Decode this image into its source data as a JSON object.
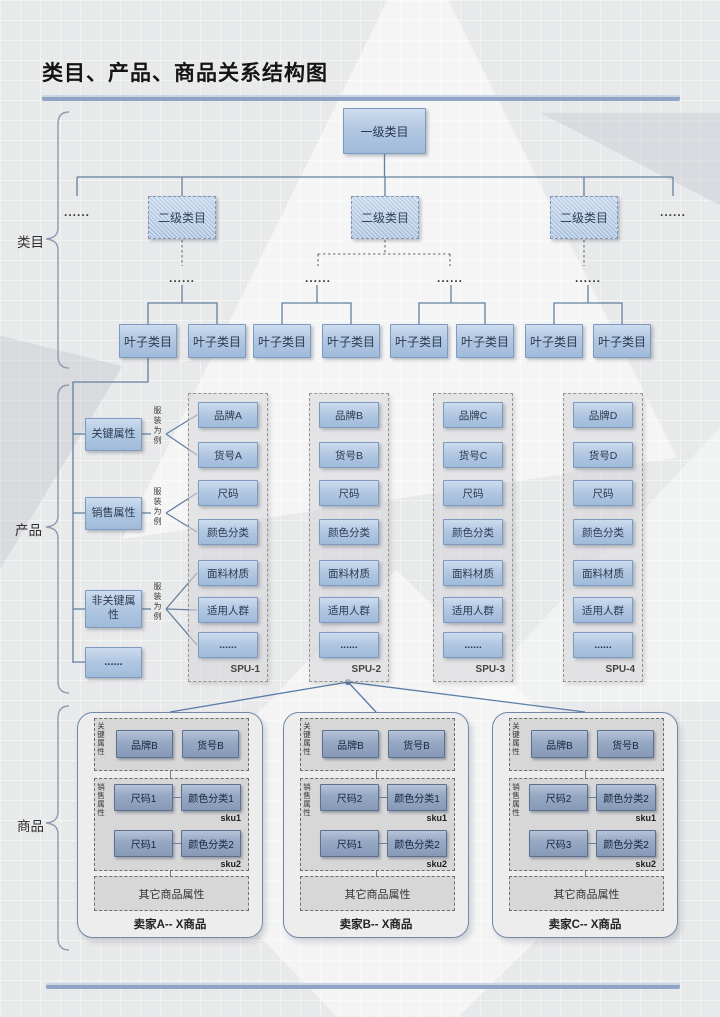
{
  "title": "类目、产品、商品关系结构图",
  "category": {
    "label": "类目",
    "root": "一级类目",
    "level2": [
      "二级类目",
      "二级类目",
      "二级类目"
    ],
    "ellipsis": "......",
    "leaves": [
      "叶子类目",
      "叶子类目",
      "叶子类目",
      "叶子类目",
      "叶子类目",
      "叶子类目",
      "叶子类目",
      "叶子类目"
    ]
  },
  "product": {
    "label": "产品",
    "groups": [
      {
        "name": "关键属性",
        "note": "服装为例"
      },
      {
        "name": "销售属性",
        "note": "服装为例"
      },
      {
        "name": "非关键属性",
        "note": "服装为例"
      }
    ],
    "more": "......",
    "spus": [
      {
        "name": "SPU-1",
        "attrs": [
          "品牌A",
          "货号A",
          "尺码",
          "颜色分类",
          "面料材质",
          "适用人群",
          "......"
        ]
      },
      {
        "name": "SPU-2",
        "attrs": [
          "品牌B",
          "货号B",
          "尺码",
          "颜色分类",
          "面料材质",
          "适用人群",
          "......"
        ]
      },
      {
        "name": "SPU-3",
        "attrs": [
          "品牌C",
          "货号C",
          "尺码",
          "颜色分类",
          "面料材质",
          "适用人群",
          "......"
        ]
      },
      {
        "name": "SPU-4",
        "attrs": [
          "品牌D",
          "货号D",
          "尺码",
          "颜色分类",
          "面料材质",
          "适用人群",
          "......"
        ]
      }
    ]
  },
  "commodity": {
    "label": "商品",
    "key_attr_label": "关键属性",
    "sales_attr_label": "销售属性",
    "cards": [
      {
        "title": "卖家A-- X商品",
        "brand": "品牌B",
        "item_no": "货号B",
        "other": "其它商品属性",
        "skus": [
          {
            "size": "尺码1",
            "color": "颜色分类1",
            "tag": "sku1"
          },
          {
            "size": "尺码1",
            "color": "颜色分类2",
            "tag": "sku2"
          }
        ]
      },
      {
        "title": "卖家B-- X商品",
        "brand": "品牌B",
        "item_no": "货号B",
        "other": "其它商品属性",
        "skus": [
          {
            "size": "尺码2",
            "color": "颜色分类1",
            "tag": "sku1"
          },
          {
            "size": "尺码1",
            "color": "颜色分类2",
            "tag": "sku2"
          }
        ]
      },
      {
        "title": "卖家C-- X商品",
        "brand": "品牌B",
        "item_no": "货号B",
        "other": "其它商品属性",
        "skus": [
          {
            "size": "尺码2",
            "color": "颜色分类2",
            "tag": "sku1"
          },
          {
            "size": "尺码3",
            "color": "颜色分类2",
            "tag": "sku2"
          }
        ]
      }
    ]
  },
  "colors": {
    "accent_bar": "#90a5c5",
    "box_border": "#7e9ac0",
    "connector": "#64809f"
  }
}
